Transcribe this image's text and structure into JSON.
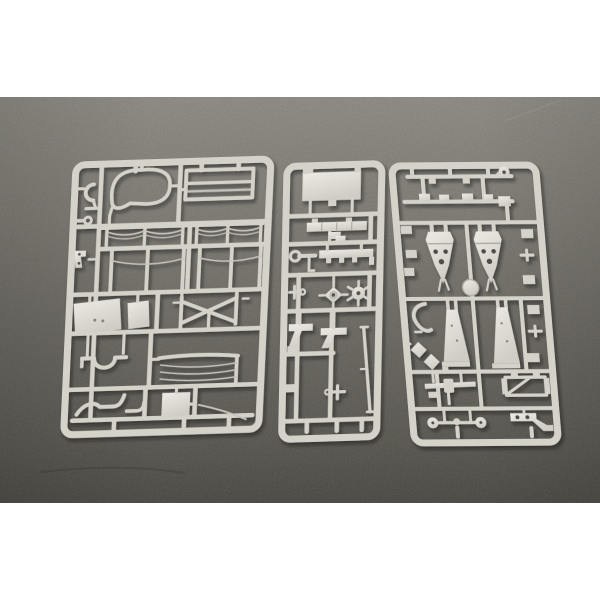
{
  "scene": {
    "type": "product-photograph",
    "aria_label": "Three light grey injection-moulded plastic model kit sprues (part frames) lying side by side on a dark grey fabric surface, white border above and below",
    "background_color": "#ffffff",
    "fabric_colors": {
      "top": "#8b8881",
      "upper_mid": "#76736c",
      "lower_mid": "#5d5a54",
      "bottom": "#363430"
    },
    "plastic_colors": {
      "base": "#d5d2ca",
      "highlight": "#eceae4",
      "shade": "#b6b3ab",
      "thin_wire": "#c7c4bc",
      "hole": "#504e49"
    },
    "sprues": [
      {
        "position": "left",
        "shape": "large rounded rectangle, slightly tilted",
        "parts": [
          "c-shaped hook",
          "curved wire loop",
          "ladder frame with cross bars",
          "two canvas-bow panels with sagging thin wires",
          "eyelet rod",
          "angle bracket with holes",
          "large flat plate",
          "small flat plate",
          "x-shaped cross brace",
          "arched bracket with central dip",
          "third wire-bow panel",
          "s-curved pipes",
          "square plate",
          "thin curved rod"
        ]
      },
      {
        "position": "middle",
        "shape": "narrow rounded rectangle",
        "parts": [
          "large rectangular panel",
          "segmented beam",
          "stepped block",
          "long beam with feet",
          "ring-ended rod",
          "small cross fitting",
          "diamond hub wheel",
          "small sprocket wheel",
          "two angled blades",
          "long diagonal rod",
          "t-shaped fitting",
          "small tabs"
        ]
      },
      {
        "position": "right",
        "shape": "rounded rectangle, widening toward bottom-right",
        "parts": [
          "round cap",
          "row of small blocks",
          "two pierced spade-shaped brackets",
          "round disc",
          "c-shaped hook",
          "two tapered trail legs",
          "two diamond plates",
          "winged spar with hub",
          "braced rectangular frame",
          "axle with round wheel ends",
          "angled bracket with holes",
          "small clips"
        ]
      }
    ]
  }
}
